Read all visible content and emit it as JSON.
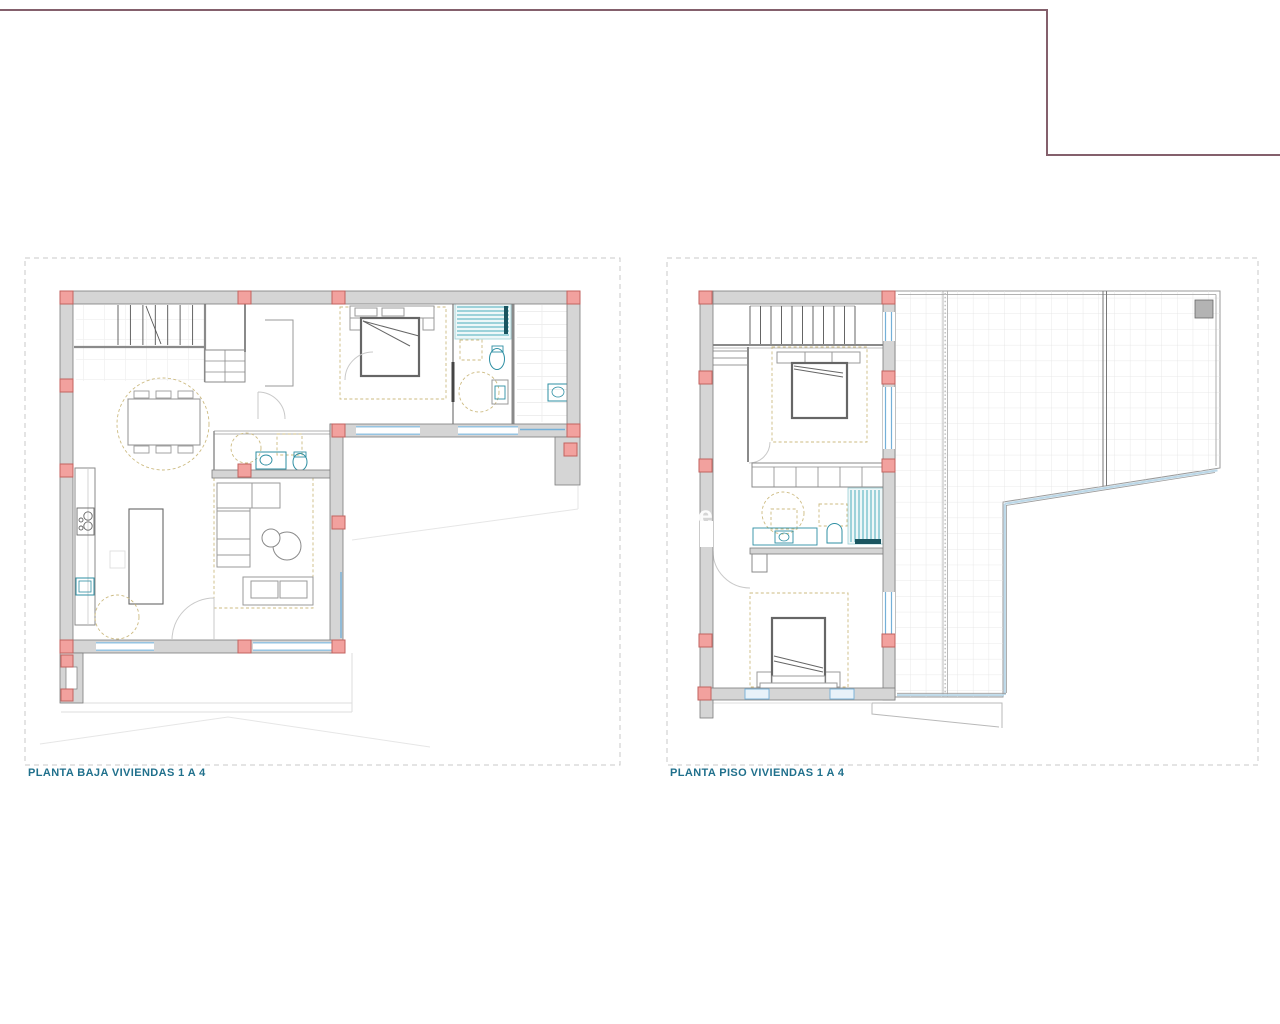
{
  "sheet": {
    "type": "architectural-floor-plan-sheet",
    "watermark": {
      "text": "ie"
    },
    "boundary_line": {
      "description": "site boundary polyline across top of sheet",
      "color": "#84606c"
    }
  },
  "plans": [
    {
      "id": "ground-floor",
      "label": "PLANTA BAJA VIVIENDAS 1 A 4",
      "rooms": [
        "staircase",
        "entry-hall",
        "dining-area",
        "kitchen",
        "living-room",
        "guest-bathroom",
        "bedroom",
        "en-suite-bathroom",
        "laundry-room",
        "porch"
      ],
      "furniture": [
        "dining-table-with-chairs",
        "kitchen-counter",
        "cooktop",
        "kitchen-sink",
        "kitchen-island",
        "round-table",
        "corner-sofa",
        "coffee-table",
        "two-seat-sofa",
        "double-bed",
        "toilet",
        "washbasin",
        "shower",
        "wardrobe"
      ]
    },
    {
      "id": "first-floor",
      "label": "PLANTA PISO VIVIENDAS 1 A 4",
      "rooms": [
        "staircase",
        "hall",
        "bedroom-1",
        "wardrobe-corridor",
        "bathroom",
        "bedroom-2",
        "roof-terrace"
      ],
      "furniture": [
        "double-bed",
        "wardrobe",
        "dressing-table",
        "washbasin",
        "toilet",
        "shower",
        "double-bed-2"
      ],
      "terrace": [
        "tiled-roof-deck",
        "expansion-joints",
        "parapet",
        "chimney",
        "entry-canopy"
      ]
    }
  ],
  "colors": {
    "background": "#ffffff",
    "boundary": "#84606c",
    "wall": "#d5d5d5",
    "wallStroke": "#7b7b7b",
    "column": "#f2a19e",
    "columnStroke": "#c2625f",
    "window": "#74b0d8",
    "windowFill": "#e8f2f9",
    "teal": "#2e8fa3",
    "showerLine": "#4aaebc",
    "showerBg": "#edf7f8",
    "showerDark": "#1a5560",
    "furniture": "#9a9a9a",
    "furnitureDark": "#666666",
    "tan": "#cdbb82",
    "tile": "#e3e3e3",
    "terraceEdge": "#9a9a9a",
    "parapetBlue": "#bcd8e8",
    "faint": "#dedede",
    "stair": "#555555",
    "dashBorder": "#c9c9c9",
    "label": "#20708c",
    "watermark": "#ffffff",
    "interior": "#8a8a8a"
  }
}
